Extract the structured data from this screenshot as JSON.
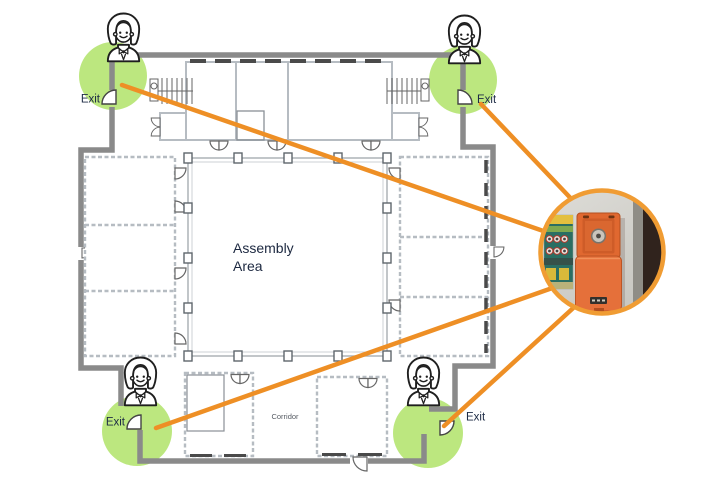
{
  "labels": {
    "assembly_line1": "Assembly",
    "assembly_line2": "Area",
    "corridor": "Corridor"
  },
  "exits": [
    {
      "position": "top-left",
      "label": "Exit"
    },
    {
      "position": "top-right",
      "label": "Exit"
    },
    {
      "position": "bottom-left",
      "label": "Exit"
    },
    {
      "position": "bottom-right",
      "label": "Exit"
    }
  ],
  "colors": {
    "exit_highlight_green": "#bce77f",
    "callout_line_orange": "#ee8f25",
    "callout_ring_orange": "#f09c33",
    "outer_wall_gray": "#8a8a8a",
    "device_orange": "#e5703a",
    "label_navy": "#1d2b45"
  },
  "icons": {
    "warden": "female-warden-avatar-icon",
    "exit_door": "exit-door-swing-icon",
    "callout": "emergency-call-point-photo"
  }
}
